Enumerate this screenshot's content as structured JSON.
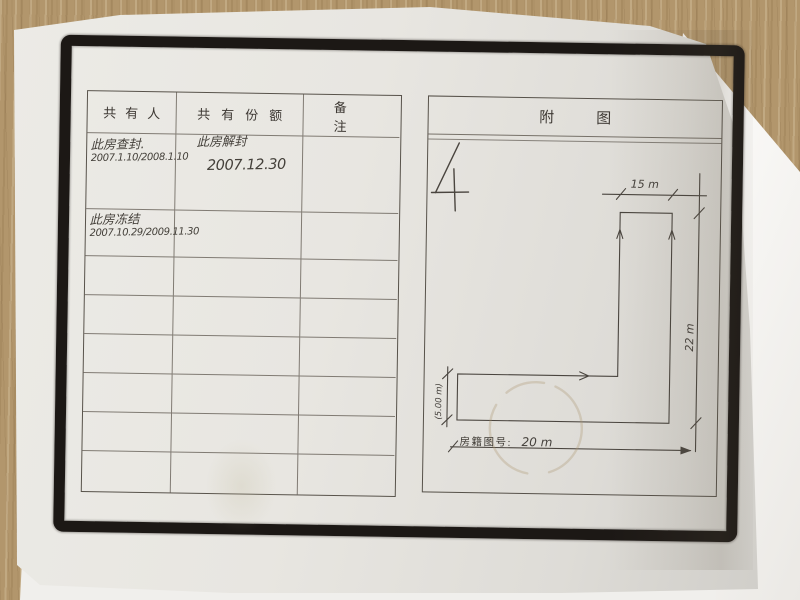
{
  "table": {
    "headers": [
      "共有人",
      "共有份额",
      "备注"
    ],
    "entries": {
      "row1": {
        "owner_line1": "此房查封.",
        "owner_line2": "2007.1.10/2008.1.10",
        "share_line1": "此房解封",
        "share_line2": "2007.12.30"
      },
      "row2": {
        "owner_line1": "此房冻结",
        "owner_line2": "2007.10.29/2009.11.30"
      }
    },
    "empty_rows": 6
  },
  "figure": {
    "title": "附图",
    "page_number": "4",
    "dim_top": "15 m",
    "dim_right": "22 m",
    "dim_left": "(5.00 m)",
    "dim_bottom_value": "20 m",
    "map_number_label": "房籍图号:"
  },
  "colors": {
    "wood": "#b2966c",
    "paper": "#e8e6e1",
    "frame_ink": "#1c1815",
    "print_line": "#4b453f",
    "handwriting": "#44403a",
    "folded_page": "#f7f6f3"
  }
}
